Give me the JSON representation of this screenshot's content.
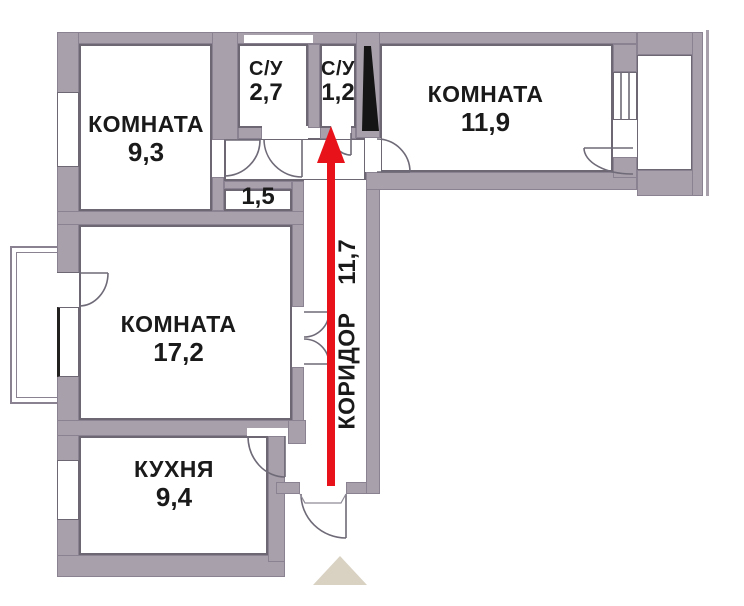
{
  "rooms": {
    "room_9_3": {
      "name": "КОМНАТА",
      "area": "9,3"
    },
    "bath_2_7": {
      "name": "С/У",
      "area": "2,7"
    },
    "bath_1_2": {
      "name": "С/У",
      "area": "1,2"
    },
    "room_11_9": {
      "name": "КОМНАТА",
      "area": "11,9"
    },
    "closet_1_5": {
      "area": "1,5"
    },
    "room_17_2": {
      "name": "КОМНАТА",
      "area": "17,2"
    },
    "kitchen_9_4": {
      "name": "КУХНЯ",
      "area": "9,4"
    },
    "corridor": {
      "name": "КОРИДОР",
      "area": "11,7"
    }
  },
  "colors": {
    "wall": "#a8a0ab",
    "line": "#8a8290",
    "edge": "#6d6773",
    "arrow": "#e8131a",
    "triangle": "#d9d2c3",
    "text": "#1a1a1a",
    "shaft": "#151515"
  }
}
